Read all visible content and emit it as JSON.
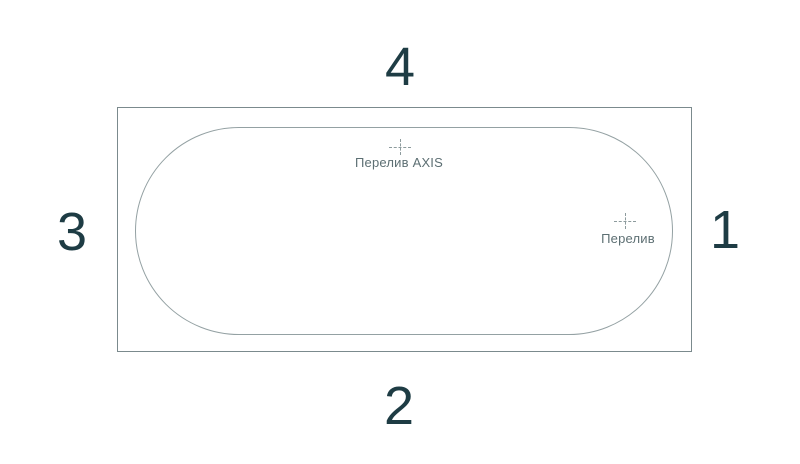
{
  "diagram": {
    "title": "bathtub-top-view-installation-diagram",
    "side_labels": {
      "top": "4",
      "right": "1",
      "bottom": "2",
      "left": "3"
    },
    "markers": [
      {
        "label": "Перелив AXIS"
      },
      {
        "label": "Перелив"
      }
    ],
    "colors": {
      "number_text": "#1e3c44",
      "label_text": "#5d6f73",
      "line_outer": "#7b8a8d",
      "line_inner": "#94a1a3",
      "mark_color": "#8d9b9d",
      "background": "#ffffff"
    }
  }
}
